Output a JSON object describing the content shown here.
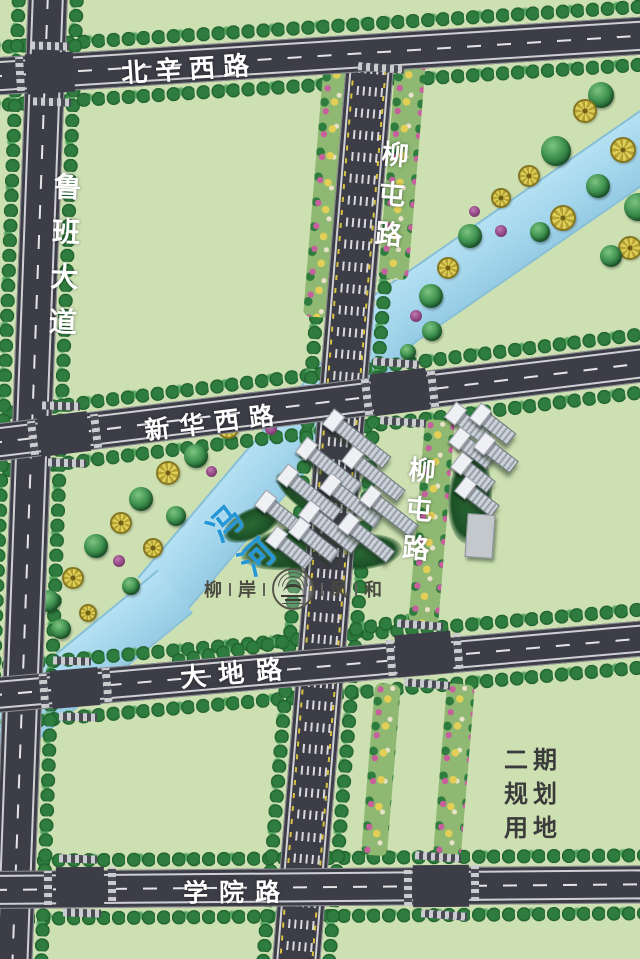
{
  "map": {
    "title": "residential development site plan",
    "roads": {
      "beixin_west": "北辛西路",
      "luban_avenue": "鲁班大道",
      "liutun_top": "柳屯路",
      "liutun_mid": "柳屯路",
      "xinhua_west": "新华西路",
      "dadi": "大地路",
      "xueyuan": "学院路"
    },
    "river": {
      "name": "冯河"
    },
    "logo": {
      "chars": [
        "柳",
        "岸",
        "风",
        "和"
      ]
    },
    "phase2": {
      "lines": [
        "二期",
        "规划",
        "用地"
      ]
    },
    "colors": {
      "land_green": "#cde0b2",
      "road_asphalt": "#3d3d47",
      "river_blue": "#a3d6ec",
      "river_label_blue": "#2596d6",
      "road_label_white": "#ffffff",
      "phase2_gray": "#3b3b3b",
      "tree_green": "#2e7d3e",
      "lane_yellow": "#d9c23e"
    }
  }
}
